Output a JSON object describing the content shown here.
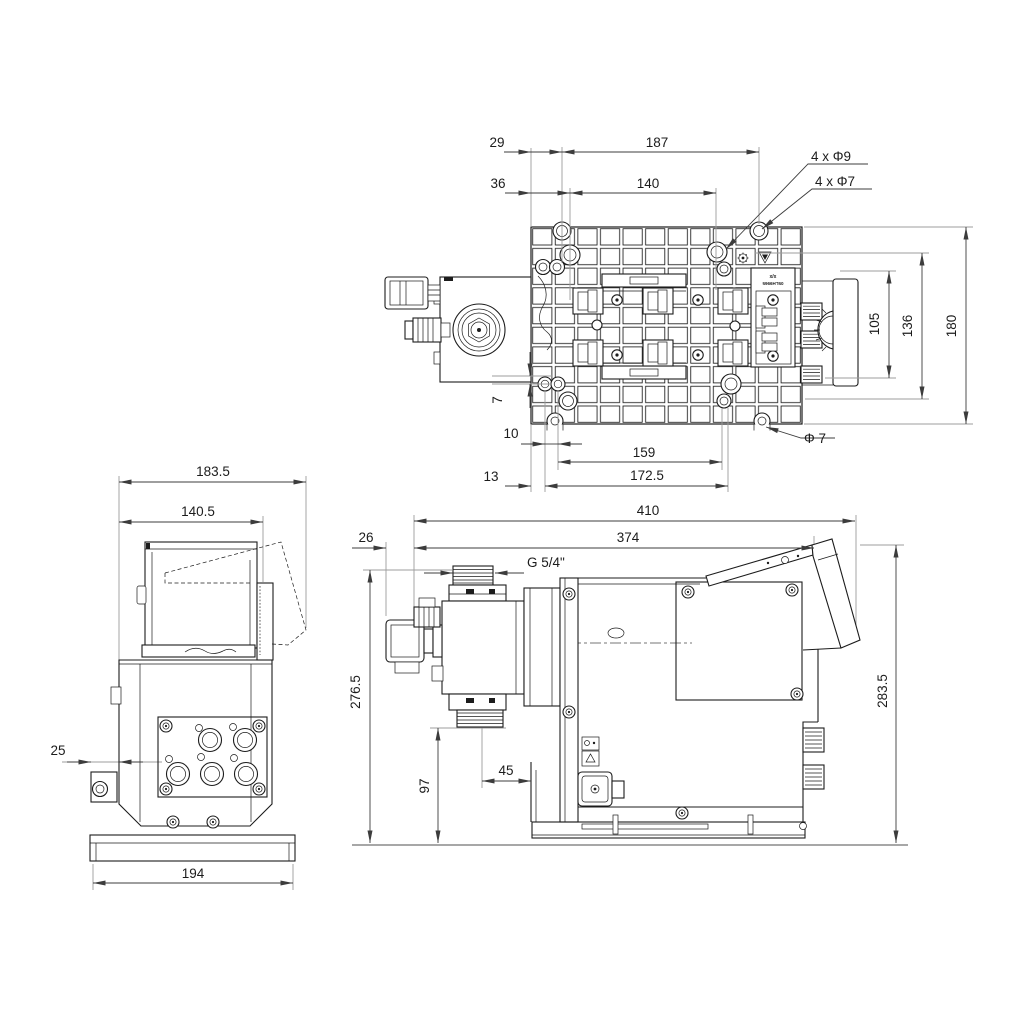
{
  "colors": {
    "line": "#1c1c1c",
    "dimension": "#3c3c3c",
    "extension": "#9c9c9c",
    "background": "#ffffff"
  },
  "top_view": {
    "dims": {
      "edge_to_hole": "29",
      "outer_hole_span": "187",
      "edge_to_inner_hole": "36",
      "inner_hole_span": "140",
      "holes_big": "4 x Φ9",
      "holes_small": "4 x Φ7",
      "body_height": "105",
      "hole_row_span": "136",
      "plate_height": "180",
      "row_gap": "7",
      "slot_offset": "10",
      "bottom_hole_span": "159",
      "hole_dia": "Φ 7",
      "edge_offset": "13",
      "bottom_outer_span": "172.5"
    },
    "tag": {
      "line1": "x/x",
      "line2": "05LH9965"
    }
  },
  "left_view": {
    "dims": {
      "depth_total": "183.5",
      "depth_body": "140.5",
      "bracket_offset": "25",
      "base_depth": "194"
    }
  },
  "side_view": {
    "dims": {
      "length_total": "410",
      "length_body": "374",
      "gland_offset": "26",
      "thread_size": "G 5/4\"",
      "valve_height": "276.5",
      "suction_height": "97",
      "valve_offset": "45",
      "height_total": "283.5"
    }
  }
}
